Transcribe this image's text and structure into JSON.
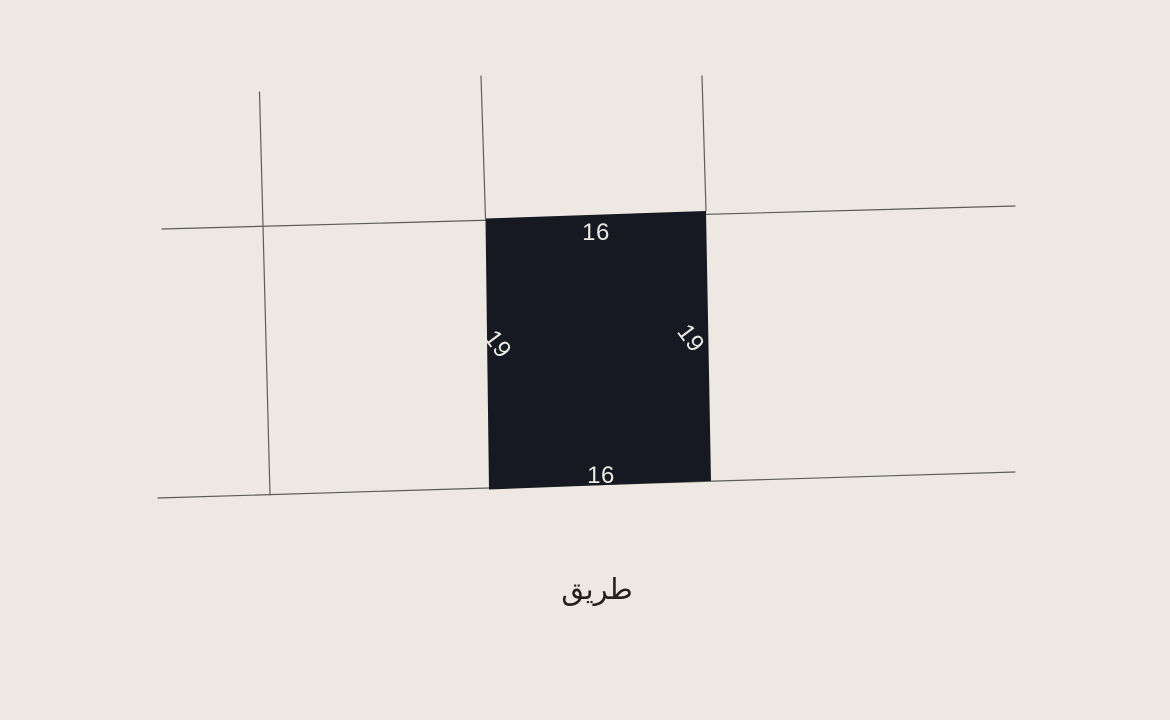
{
  "map": {
    "background_color": "#EDE9E2",
    "boundary_line_color": "#5E5C57",
    "parcel": {
      "fill_color": "#161922",
      "label_color": "#ECE9E2",
      "dimensions": {
        "top": "16",
        "bottom": "16",
        "left": "19",
        "right": "19"
      }
    },
    "road": {
      "label": "طريق",
      "label_color": "#24211C"
    }
  }
}
